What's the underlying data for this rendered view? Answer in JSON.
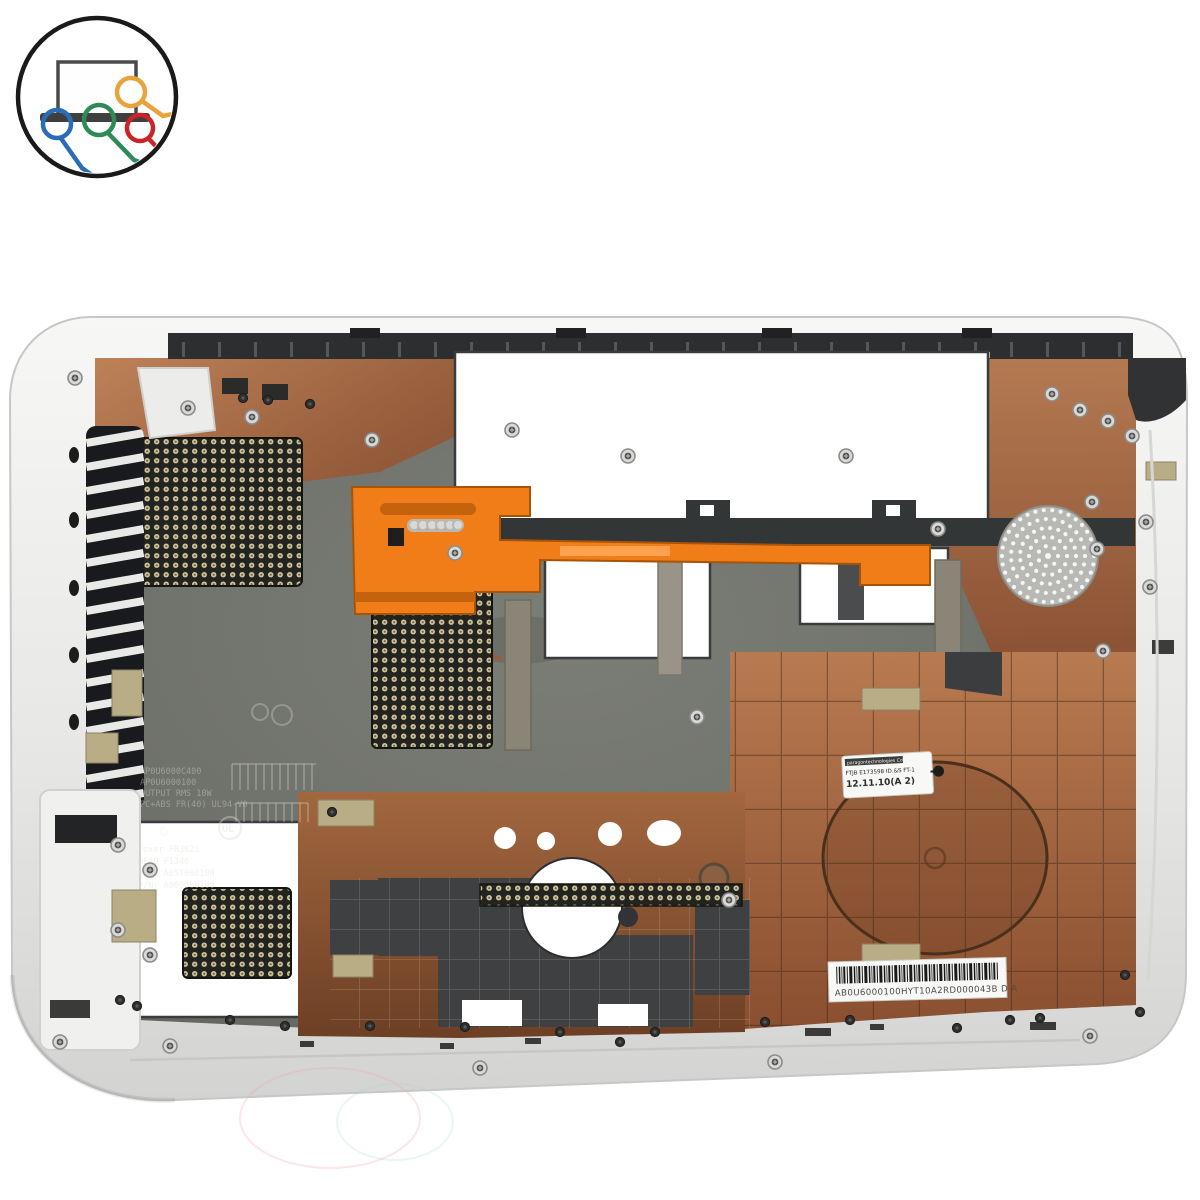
{
  "page": {
    "alt": "Top-down product photo of a white laptop bottom-case plastic part with copper EMI coating, orange battery latch slider, cooling vent meshes, speaker grille and service stickers, shop logo in corner"
  },
  "logo": {
    "title": "laptop-parts-shop-logo"
  },
  "labels": {
    "spec_sticker": {
      "line1": "paragontechnologies Co.,Ltd",
      "line2": "FTJB E173598 ID.&S FT-1",
      "line3": "12.11.10(A  2)"
    },
    "barcode_sticker": {
      "code": "AB0U6000100HYT10A2RD000043B  D A"
    }
  },
  "molded_text": {
    "block1": [
      "AP0U6000C400",
      "AP0U6000100",
      "OUTPUT RMS 10W",
      "PC+ABS FR(40) UL94-V0"
    ],
    "block2": [
      "Foxer FR3021",
      "HEAO F1346",
      "P/N: A05T000100",
      "P/N: A009000100"
    ],
    "recycle_symbol": "♲",
    "ul_mark": "UL"
  },
  "colors": {
    "page-bg": "#ffffff",
    "case-rim": "#ededeb",
    "case-edge": "#c7c7c5",
    "interior": "#6e716a",
    "copper": "#b06f48",
    "copper-dark": "#7c4527",
    "orange": "#f07d18",
    "orange-dark": "#c4620e",
    "rail": "#2c2e2f",
    "mesh-bg": "#23231f",
    "mesh-dot": "#d0c59c",
    "speaker": "#b8b8b4",
    "foam": "#b9ad86",
    "sticker": "#f8f8f6",
    "ink": "#2d2d2b",
    "logo-blue": "#2b6cb8",
    "logo-green": "#2e8b57",
    "logo-red": "#cc2327",
    "logo-orange": "#e8a33d"
  }
}
